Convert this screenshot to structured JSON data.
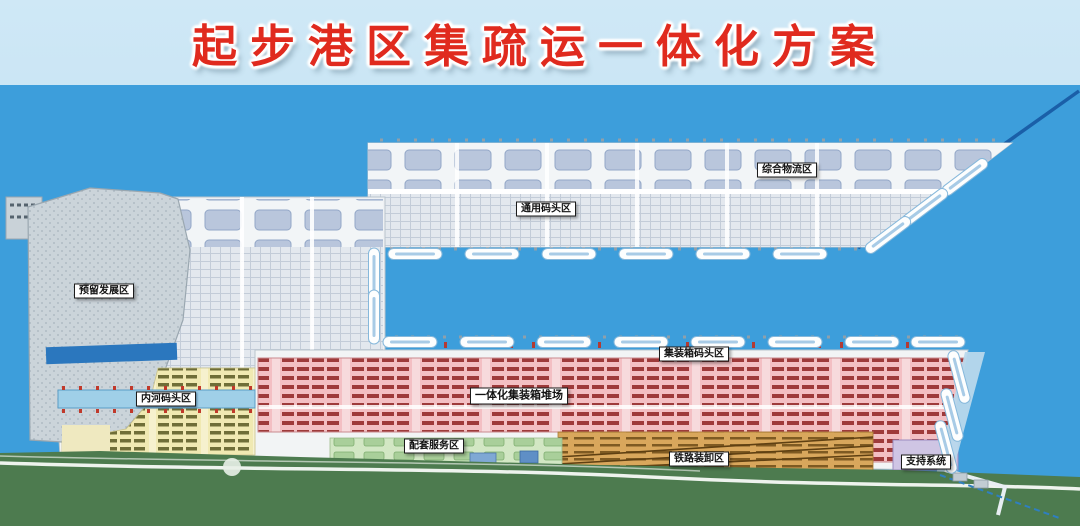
{
  "title": "起步港区集疏运一体化方案",
  "map": {
    "zones": [
      {
        "id": "reserved-development",
        "label": "预留发展区"
      },
      {
        "id": "comprehensive-logistics",
        "label": "综合物流区"
      },
      {
        "id": "general-terminal",
        "label": "通用码头区"
      },
      {
        "id": "container-terminal",
        "label": "集装箱码头区"
      },
      {
        "id": "integrated-container-yard",
        "label": "一体化集装箱堆场"
      },
      {
        "id": "inland-river-terminal",
        "label": "内河码头区"
      },
      {
        "id": "supporting-services",
        "label": "配套服务区"
      },
      {
        "id": "railway-loading",
        "label": "铁路装卸区"
      },
      {
        "id": "support-system",
        "label": "支持系统"
      }
    ],
    "colors": {
      "water": "#3d9edb",
      "title_red": "#e02a1e",
      "banner_blue": "#c3e2f2",
      "reserved_gray": "#cbd4da",
      "container_yard_pink": "#f3bfc3",
      "inland_yellow": "#f0e9b2",
      "railway_orange": "#d9a75c",
      "services_green": "#d2e7c4",
      "greenbelt": "#4d7b4f",
      "breakwater": "#1a5fa8"
    }
  }
}
